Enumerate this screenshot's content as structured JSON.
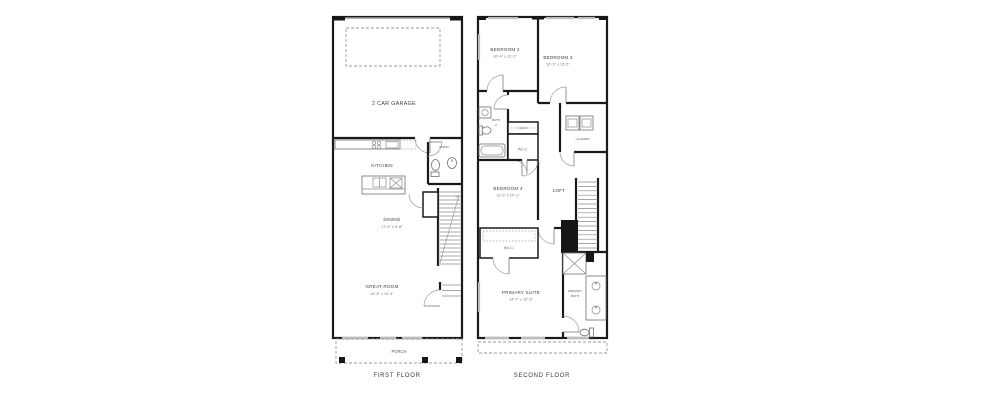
{
  "first_floor": {
    "caption": "FIRST FLOOR",
    "rooms": {
      "garage": {
        "name": "2 CAR GARAGE"
      },
      "kitchen": {
        "name": "KITCHEN"
      },
      "pwdr": {
        "name": "PWDR"
      },
      "dining": {
        "name": "DINING",
        "dims": "17'-5\" x 9'-8\""
      },
      "great_room": {
        "name": "GREAT ROOM",
        "dims": "14'-5\" x 15'-4\""
      },
      "porch": {
        "name": "PORCH"
      }
    }
  },
  "second_floor": {
    "caption": "SECOND FLOOR",
    "rooms": {
      "bedroom2": {
        "name": "BEDROOM 2",
        "dims": "10'-4\" x 11'-1\""
      },
      "bedroom3": {
        "name": "BEDROOM 3",
        "dims": "10'-3\" x 13'-5\""
      },
      "bath2": {
        "name": "BATH",
        "number": "2"
      },
      "linen": {
        "name": "LINEN"
      },
      "wic_hall": {
        "name": "W.I.C."
      },
      "laundry": {
        "name": "LAUNDRY"
      },
      "bedroom4": {
        "name": "BEDROOM 4",
        "dims": "11'-0\" x 10'-1\""
      },
      "loft": {
        "name": "LOFT"
      },
      "wic_primary": {
        "name": "W.I.C."
      },
      "primary_suite": {
        "name": "PRIMARY SUITE",
        "dims": "14'-7\" x 15'-3\""
      },
      "primary_bath": {
        "line1": "PRIMARY",
        "line2": "BATH"
      }
    }
  }
}
